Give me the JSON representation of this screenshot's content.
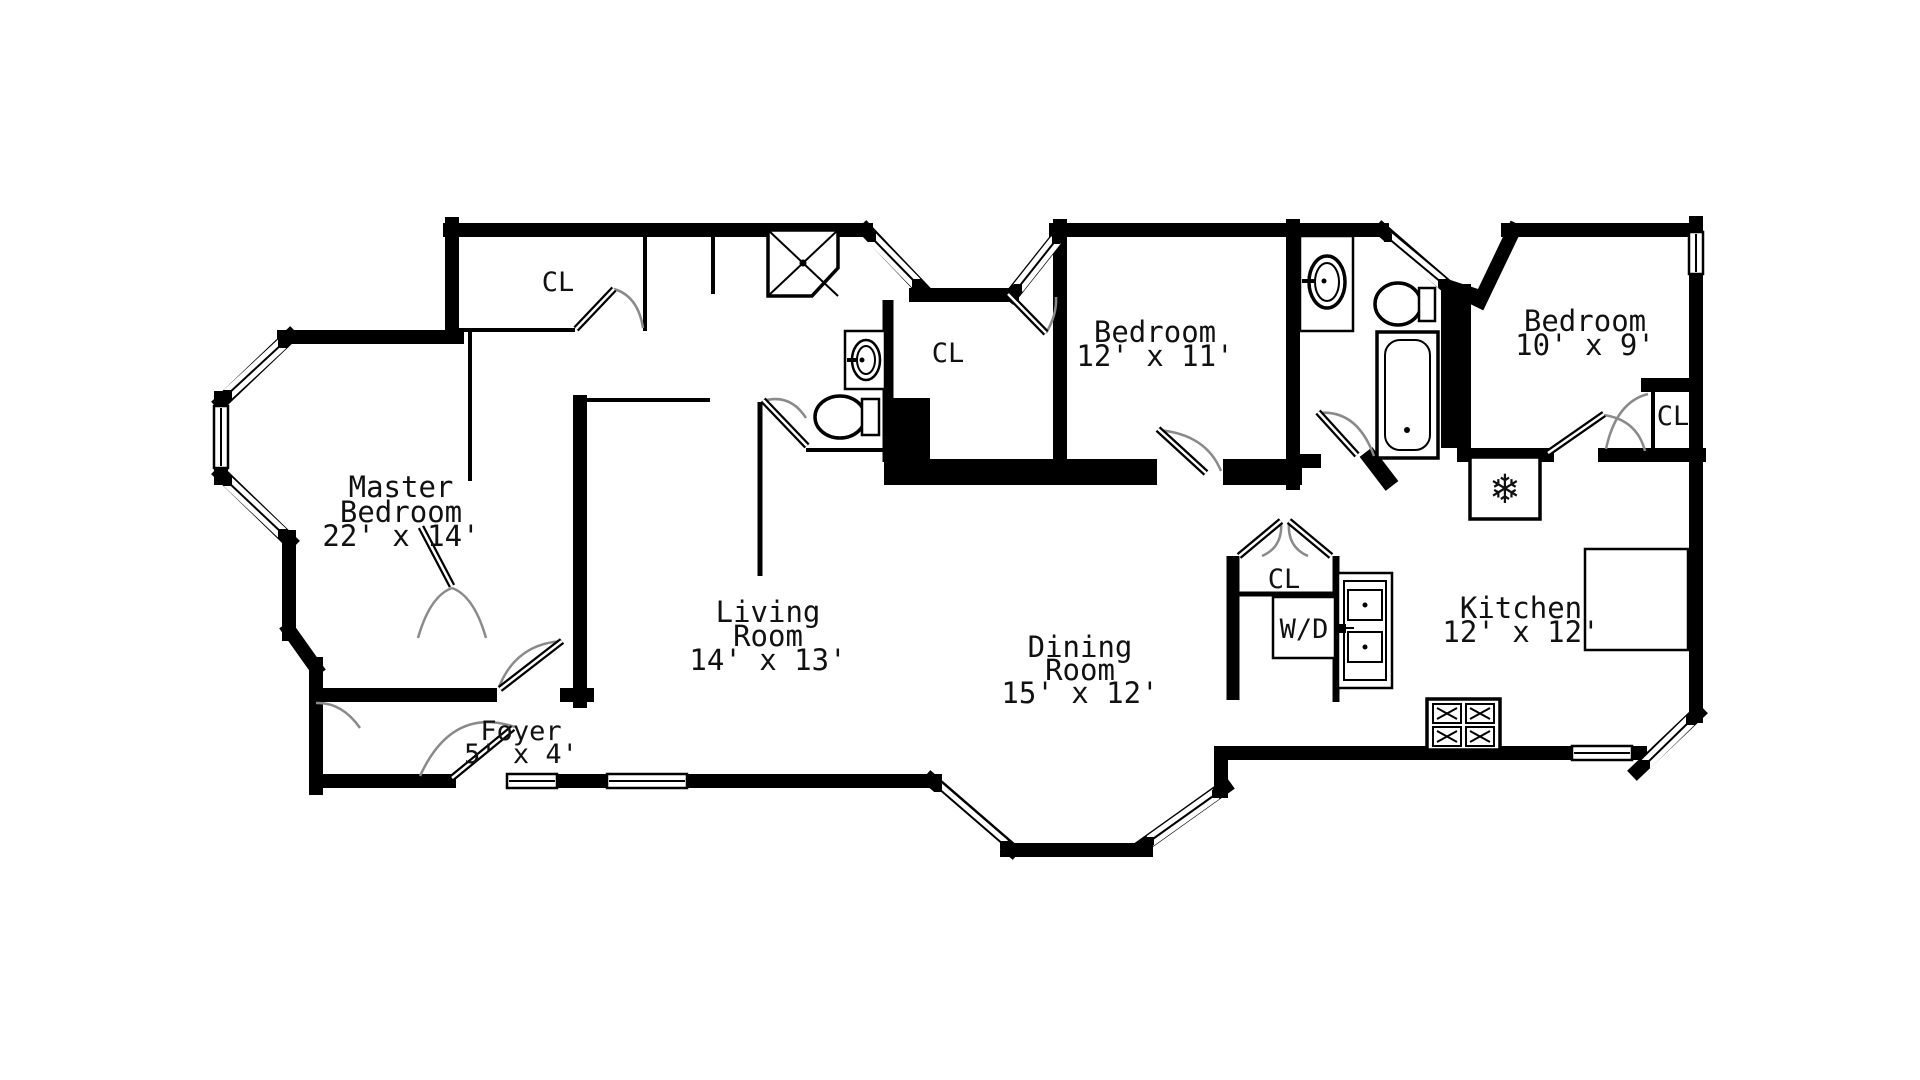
{
  "plan_title": "Apartment Floor Plan",
  "colors": {
    "wall": "#000000",
    "background": "#ffffff",
    "door_arc": "#8a8a8a",
    "fixture_gray": "#9b9b9b"
  },
  "rooms": {
    "master_bedroom": {
      "lines": [
        "Master",
        "Bedroom",
        "22' x 14'"
      ]
    },
    "living_room": {
      "lines": [
        "Living",
        "Room",
        "14' x 13'"
      ]
    },
    "dining_room": {
      "lines": [
        "Dining",
        "Room",
        "15' x 12'"
      ]
    },
    "bedroom_middle": {
      "lines": [
        "Bedroom",
        "12' x 11'"
      ]
    },
    "bedroom_right": {
      "lines": [
        "Bedroom",
        "10' x 9'"
      ]
    },
    "kitchen": {
      "lines": [
        "Kitchen",
        "12' x 12'"
      ]
    },
    "foyer": {
      "lines": [
        "Foyer",
        "5' x 4'"
      ]
    }
  },
  "closets": {
    "master_closet": "CL",
    "hall_closet": "CL",
    "utility_closet": "CL",
    "bedroom_right_closet": "CL"
  },
  "laundry": {
    "washer_dryer": "W/D"
  },
  "icons": {
    "fridge_snowflake": "❄"
  }
}
